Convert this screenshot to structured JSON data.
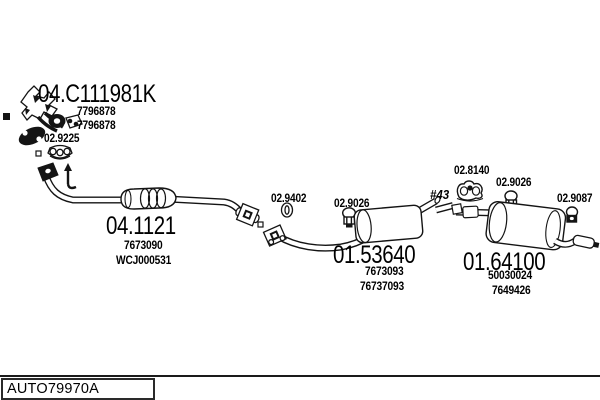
{
  "colors": {
    "ink": "#141414",
    "background": "#ffffff"
  },
  "plate": {
    "code": "AUTO79970A"
  },
  "parts": {
    "manifold": {
      "code": "04.C111981K",
      "refs": [
        "7796878",
        "7796878"
      ]
    },
    "manifold_gasket": {
      "code": "02.9225"
    },
    "front_pipe": {
      "code": "04.1121",
      "refs": [
        "7673090",
        "WCJ000531"
      ]
    },
    "seal_ring": {
      "code": "02.9402"
    },
    "clamp_front": {
      "code": "02.9026"
    },
    "centre_muffler": {
      "code": "01.53640",
      "refs": [
        "7673093",
        "76737093"
      ]
    },
    "pipe_diameter": {
      "code": "#43"
    },
    "rubber_hanger": {
      "code": "02.8140"
    },
    "clamp_rear": {
      "code": "02.9026"
    },
    "clamp_tail": {
      "code": "02.9087"
    },
    "rear_muffler": {
      "code": "01.64100",
      "refs": [
        "50030024",
        "7649426"
      ]
    }
  }
}
